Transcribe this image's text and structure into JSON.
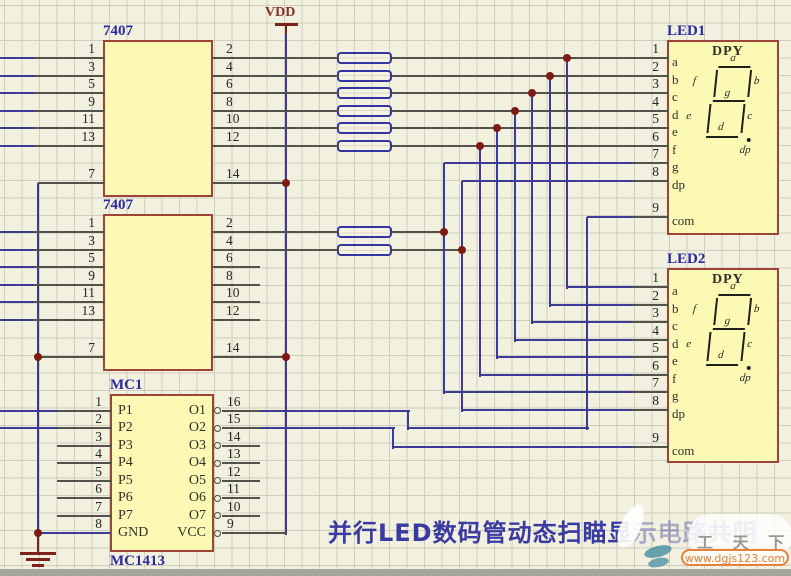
{
  "palette": {
    "background": "#f2f0de",
    "grid_line": "#cfcdbb",
    "block_fill": "#fcf9b4",
    "block_border": "#9c4438",
    "wire_blue": "#3b3b97",
    "wire_dark": "#52524a",
    "power_red": "#7c241c",
    "junction_dot": "#7e1a14",
    "label_blue": "#2a2aa0",
    "title_blue": "#3a3aa4",
    "watermark_orange": "#e4813e",
    "watermark_teal": "#4f93a3"
  },
  "labels": {
    "vdd": "VDD",
    "title_main": "并行LED数码管动态扫瞄显",
    "title_faded": "示电路共阴",
    "watermark_brand": "工 天 下",
    "watermark_url": "www.dgjs123.com"
  },
  "schematic": {
    "ics": [
      {
        "ref": "7407",
        "ref_pos": [
          103,
          23
        ],
        "box": [
          103,
          40,
          110,
          157
        ],
        "pins_left": [
          {
            "num": "1",
            "y": 58,
            "stub": [
              34,
              103
            ],
            "wire": [
              0,
              34
            ]
          },
          {
            "num": "3",
            "y": 75.5,
            "stub": [
              34,
              103
            ],
            "wire": [
              0,
              34
            ]
          },
          {
            "num": "5",
            "y": 93,
            "stub": [
              34,
              103
            ],
            "wire": [
              0,
              34
            ]
          },
          {
            "num": "9",
            "y": 110.5,
            "stub": [
              34,
              103
            ],
            "wire": [
              0,
              34
            ]
          },
          {
            "num": "11",
            "y": 128,
            "stub": [
              34,
              103
            ],
            "wire": [
              0,
              34
            ]
          },
          {
            "num": "13",
            "y": 145.5,
            "stub": [
              34,
              103
            ],
            "wire": [
              0,
              34
            ]
          },
          {
            "num": "7",
            "y": 183,
            "stub": [
              38,
              103
            ]
          }
        ],
        "pins_right": [
          {
            "num": "2",
            "y": 58,
            "stub": [
              213,
              337
            ]
          },
          {
            "num": "4",
            "y": 75.5,
            "stub": [
              213,
              337
            ]
          },
          {
            "num": "6",
            "y": 93,
            "stub": [
              213,
              337
            ]
          },
          {
            "num": "8",
            "y": 110.5,
            "stub": [
              213,
              337
            ]
          },
          {
            "num": "10",
            "y": 128,
            "stub": [
              213,
              337
            ]
          },
          {
            "num": "12",
            "y": 145.5,
            "stub": [
              213,
              337
            ]
          },
          {
            "num": "14",
            "y": 183,
            "stub": [
              213,
              285
            ]
          }
        ]
      },
      {
        "ref": "7407",
        "ref_pos": [
          103,
          197
        ],
        "box": [
          103,
          214,
          110,
          157
        ],
        "pins_left": [
          {
            "num": "1",
            "y": 232,
            "stub": [
              34,
              103
            ],
            "wire": [
              0,
              34
            ]
          },
          {
            "num": "3",
            "y": 249.5,
            "stub": [
              34,
              103
            ],
            "wire": [
              0,
              34
            ]
          },
          {
            "num": "5",
            "y": 267,
            "stub": [
              34,
              103
            ],
            "wire": [
              0,
              34
            ]
          },
          {
            "num": "9",
            "y": 284.5,
            "stub": [
              34,
              103
            ],
            "wire": [
              0,
              34
            ]
          },
          {
            "num": "11",
            "y": 302,
            "stub": [
              34,
              103
            ],
            "wire": [
              0,
              34
            ]
          },
          {
            "num": "13",
            "y": 319.5,
            "stub": [
              34,
              103
            ],
            "wire": [
              0,
              34
            ]
          },
          {
            "num": "7",
            "y": 357,
            "stub": [
              38,
              103
            ]
          }
        ],
        "pins_right": [
          {
            "num": "2",
            "y": 232,
            "stub": [
              213,
              337
            ]
          },
          {
            "num": "4",
            "y": 249.5,
            "stub": [
              213,
              337
            ]
          },
          {
            "num": "6",
            "y": 267,
            "stub": [
              213,
              258
            ]
          },
          {
            "num": "8",
            "y": 284.5,
            "stub": [
              213,
              258
            ]
          },
          {
            "num": "10",
            "y": 302,
            "stub": [
              213,
              258
            ]
          },
          {
            "num": "12",
            "y": 319.5,
            "stub": [
              213,
              258
            ]
          },
          {
            "num": "14",
            "y": 357,
            "stub": [
              213,
              285
            ]
          }
        ]
      },
      {
        "ref": "MC1",
        "ref_pos": [
          110,
          377
        ],
        "subref": "MC1413",
        "subref_pos": [
          110,
          553
        ],
        "box": [
          110,
          394,
          104,
          158
        ],
        "pins_left": [
          {
            "num": "1",
            "y": 410.5,
            "name": "P1",
            "stub": [
              58,
              110
            ],
            "wire": [
              0,
              58
            ]
          },
          {
            "num": "2",
            "y": 428,
            "name": "P2",
            "stub": [
              58,
              110
            ],
            "wire": [
              0,
              58
            ]
          },
          {
            "num": "3",
            "y": 445.5,
            "name": "P3",
            "stub": [
              57,
              110
            ]
          },
          {
            "num": "4",
            "y": 463,
            "name": "P4",
            "stub": [
              57,
              110
            ]
          },
          {
            "num": "5",
            "y": 480.5,
            "name": "P5",
            "stub": [
              57,
              110
            ]
          },
          {
            "num": "6",
            "y": 498,
            "name": "P6",
            "stub": [
              57,
              110
            ]
          },
          {
            "num": "7",
            "y": 515.5,
            "name": "P7",
            "stub": [
              57,
              110
            ]
          },
          {
            "num": "8",
            "y": 533,
            "name": "GND"
          }
        ],
        "pins_right": [
          {
            "num": "16",
            "y": 410.5,
            "name": "O1",
            "bubble": true,
            "stub": [
              222,
              258
            ]
          },
          {
            "num": "15",
            "y": 428,
            "name": "O2",
            "bubble": true,
            "stub": [
              222,
              258
            ]
          },
          {
            "num": "14",
            "y": 445.5,
            "name": "O3",
            "bubble": true,
            "stub": [
              222,
              258
            ]
          },
          {
            "num": "13",
            "y": 463,
            "name": "O4",
            "bubble": true,
            "stub": [
              222,
              258
            ]
          },
          {
            "num": "12",
            "y": 480.5,
            "name": "O5",
            "bubble": true,
            "stub": [
              222,
              258
            ]
          },
          {
            "num": "11",
            "y": 498,
            "name": "O6",
            "bubble": true,
            "stub": [
              222,
              258
            ]
          },
          {
            "num": "10",
            "y": 515.5,
            "name": "O7",
            "bubble": true,
            "stub": [
              222,
              258
            ]
          },
          {
            "num": "9",
            "y": 533,
            "name": "VCC",
            "bubble": true,
            "stub": [
              222,
              285
            ]
          }
        ]
      }
    ],
    "displays": [
      {
        "ref": "LED1",
        "ref_pos": [
          667,
          23
        ],
        "type_label": "DPY",
        "box": [
          667,
          40,
          112,
          195
        ],
        "seg_origin": [
          700,
          60
        ],
        "pins": [
          {
            "num": "1",
            "y": 58,
            "name": "a"
          },
          {
            "num": "2",
            "y": 75.5,
            "name": "b"
          },
          {
            "num": "3",
            "y": 93,
            "name": "c"
          },
          {
            "num": "4",
            "y": 110.5,
            "name": "d"
          },
          {
            "num": "5",
            "y": 128,
            "name": "e"
          },
          {
            "num": "6",
            "y": 145.5,
            "name": "f"
          },
          {
            "num": "7",
            "y": 163,
            "name": "g"
          },
          {
            "num": "8",
            "y": 180.5,
            "name": "dp"
          },
          {
            "num": "9",
            "y": 217,
            "name": "com"
          }
        ],
        "segment_labels": {
          "a": "a",
          "b": "b",
          "c": "c",
          "d": "d",
          "e": "e",
          "f": "f",
          "g": "g",
          "dp": "dp"
        }
      },
      {
        "ref": "LED2",
        "ref_pos": [
          667,
          251
        ],
        "type_label": "DPY",
        "box": [
          667,
          268,
          112,
          195
        ],
        "seg_origin": [
          700,
          288
        ],
        "pins": [
          {
            "num": "1",
            "y": 287,
            "name": "a"
          },
          {
            "num": "2",
            "y": 304.5,
            "name": "b"
          },
          {
            "num": "3",
            "y": 322,
            "name": "c"
          },
          {
            "num": "4",
            "y": 339.5,
            "name": "d"
          },
          {
            "num": "5",
            "y": 357,
            "name": "e"
          },
          {
            "num": "6",
            "y": 374.5,
            "name": "f"
          },
          {
            "num": "7",
            "y": 392,
            "name": "g"
          },
          {
            "num": "8",
            "y": 409.5,
            "name": "dp"
          },
          {
            "num": "9",
            "y": 446.5,
            "name": "com"
          }
        ],
        "segment_labels": {
          "a": "a",
          "b": "b",
          "c": "c",
          "d": "d",
          "e": "e",
          "f": "f",
          "g": "g",
          "dp": "dp"
        }
      }
    ],
    "resistors": [
      {
        "x": 337,
        "y": 52,
        "w": 55,
        "h": 12
      },
      {
        "x": 337,
        "y": 69.5,
        "w": 55,
        "h": 12
      },
      {
        "x": 337,
        "y": 87,
        "w": 55,
        "h": 12
      },
      {
        "x": 337,
        "y": 104.5,
        "w": 55,
        "h": 12
      },
      {
        "x": 337,
        "y": 122,
        "w": 55,
        "h": 12
      },
      {
        "x": 337,
        "y": 139.5,
        "w": 55,
        "h": 12
      },
      {
        "x": 337,
        "y": 226,
        "w": 55,
        "h": 12
      },
      {
        "x": 337,
        "y": 243.5,
        "w": 55,
        "h": 12
      }
    ],
    "wires": [
      {
        "c": "r",
        "pts": [
          [
            286,
            23
          ],
          [
            286,
            36
          ]
        ]
      },
      {
        "c": "b",
        "pts": [
          [
            286,
            34
          ],
          [
            286,
            533
          ]
        ]
      },
      {
        "c": "b",
        "pts": [
          [
            38,
            183
          ],
          [
            38,
            533
          ]
        ]
      },
      {
        "c": "b",
        "pts": [
          [
            38,
            533
          ],
          [
            110,
            533
          ]
        ]
      },
      {
        "c": "r",
        "pts": [
          [
            38,
            533
          ],
          [
            38,
            552
          ]
        ]
      },
      {
        "c": "d",
        "pts": [
          [
            392,
            58
          ],
          [
            667,
            58
          ]
        ]
      },
      {
        "c": "d",
        "pts": [
          [
            392,
            75.5
          ],
          [
            667,
            75.5
          ]
        ]
      },
      {
        "c": "d",
        "pts": [
          [
            392,
            93
          ],
          [
            667,
            93
          ]
        ]
      },
      {
        "c": "d",
        "pts": [
          [
            392,
            110.5
          ],
          [
            667,
            110.5
          ]
        ]
      },
      {
        "c": "d",
        "pts": [
          [
            392,
            128
          ],
          [
            667,
            128
          ]
        ]
      },
      {
        "c": "d",
        "pts": [
          [
            392,
            145.5
          ],
          [
            667,
            145.5
          ]
        ]
      },
      {
        "c": "d",
        "pts": [
          [
            392,
            232
          ],
          [
            444,
            232
          ]
        ]
      },
      {
        "c": "d",
        "pts": [
          [
            392,
            249.5
          ],
          [
            461.5,
            249.5
          ]
        ]
      },
      {
        "c": "b",
        "pts": [
          [
            567,
            58
          ],
          [
            567,
            287
          ],
          [
            667,
            287
          ]
        ]
      },
      {
        "c": "b",
        "pts": [
          [
            549.5,
            75.5
          ],
          [
            549.5,
            304.5
          ],
          [
            667,
            304.5
          ]
        ]
      },
      {
        "c": "b",
        "pts": [
          [
            532,
            93
          ],
          [
            532,
            322
          ],
          [
            667,
            322
          ]
        ]
      },
      {
        "c": "b",
        "pts": [
          [
            514.5,
            110.5
          ],
          [
            514.5,
            339.5
          ],
          [
            667,
            339.5
          ]
        ]
      },
      {
        "c": "b",
        "pts": [
          [
            497,
            128
          ],
          [
            497,
            357
          ],
          [
            667,
            357
          ]
        ]
      },
      {
        "c": "b",
        "pts": [
          [
            479.5,
            145.5
          ],
          [
            479.5,
            374.5
          ],
          [
            667,
            374.5
          ]
        ]
      },
      {
        "c": "b",
        "pts": [
          [
            667,
            163
          ],
          [
            444,
            163
          ],
          [
            444,
            392
          ],
          [
            667,
            392
          ]
        ]
      },
      {
        "c": "b",
        "pts": [
          [
            667,
            180.5
          ],
          [
            461.5,
            180.5
          ],
          [
            461.5,
            409.5
          ],
          [
            667,
            409.5
          ]
        ]
      },
      {
        "c": "b",
        "pts": [
          [
            258,
            410.5
          ],
          [
            408,
            410.5
          ],
          [
            408,
            428
          ],
          [
            587,
            428
          ],
          [
            587,
            217
          ],
          [
            667,
            217
          ]
        ]
      },
      {
        "c": "b",
        "pts": [
          [
            258,
            428
          ],
          [
            393,
            428
          ],
          [
            393,
            446.5
          ],
          [
            667,
            446.5
          ]
        ]
      }
    ],
    "dots": [
      [
        286,
        183
      ],
      [
        286,
        357
      ],
      [
        38,
        357
      ],
      [
        38,
        533
      ],
      [
        567,
        58
      ],
      [
        549.5,
        75.5
      ],
      [
        532,
        93
      ],
      [
        514.5,
        110.5
      ],
      [
        497,
        128
      ],
      [
        479.5,
        145.5
      ],
      [
        444,
        232
      ],
      [
        461.5,
        249.5
      ]
    ],
    "vdd_bar": {
      "x": 275,
      "y": 23,
      "w": 23
    },
    "ground_bars": [
      {
        "x": 20,
        "y": 552,
        "w": 36
      },
      {
        "x": 26,
        "y": 558,
        "w": 24
      },
      {
        "x": 32,
        "y": 564,
        "w": 12
      }
    ]
  }
}
